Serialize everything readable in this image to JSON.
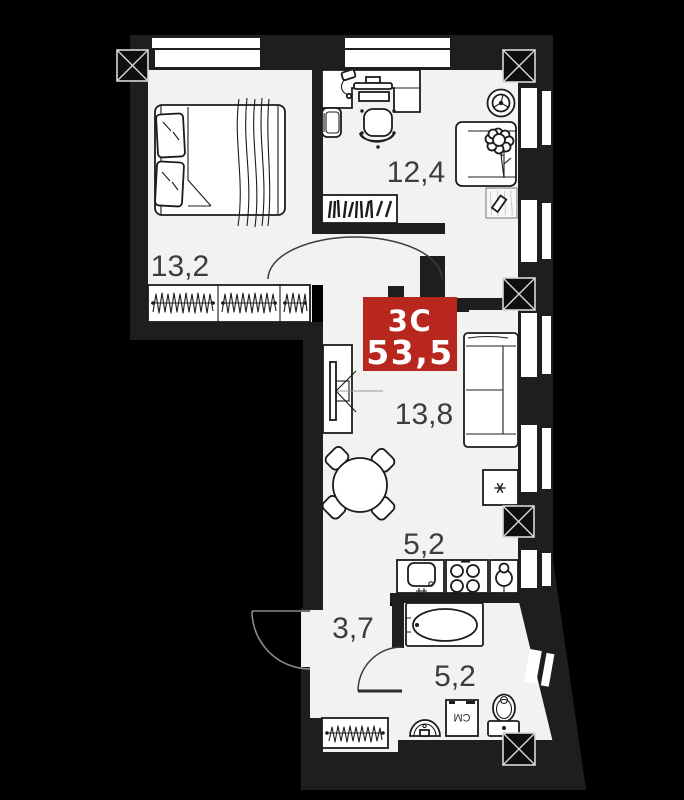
{
  "floor_plan": {
    "badge": {
      "type": "3С",
      "area": "53,5",
      "color": "#b7271d"
    },
    "rooms": {
      "bedroom": {
        "area": "13,2"
      },
      "study": {
        "area": "12,4"
      },
      "living": {
        "area": "13,8"
      },
      "kitchen": {
        "area": "5,2"
      },
      "hall": {
        "area": "3,7"
      },
      "bathroom": {
        "area": "5,2"
      }
    },
    "appliances": {
      "washing_machine": "СМ"
    },
    "colors": {
      "background": "#000000",
      "wall": "#1e1e1e",
      "floor": "#f2f2f1",
      "badge_red": "#b7271d"
    }
  }
}
